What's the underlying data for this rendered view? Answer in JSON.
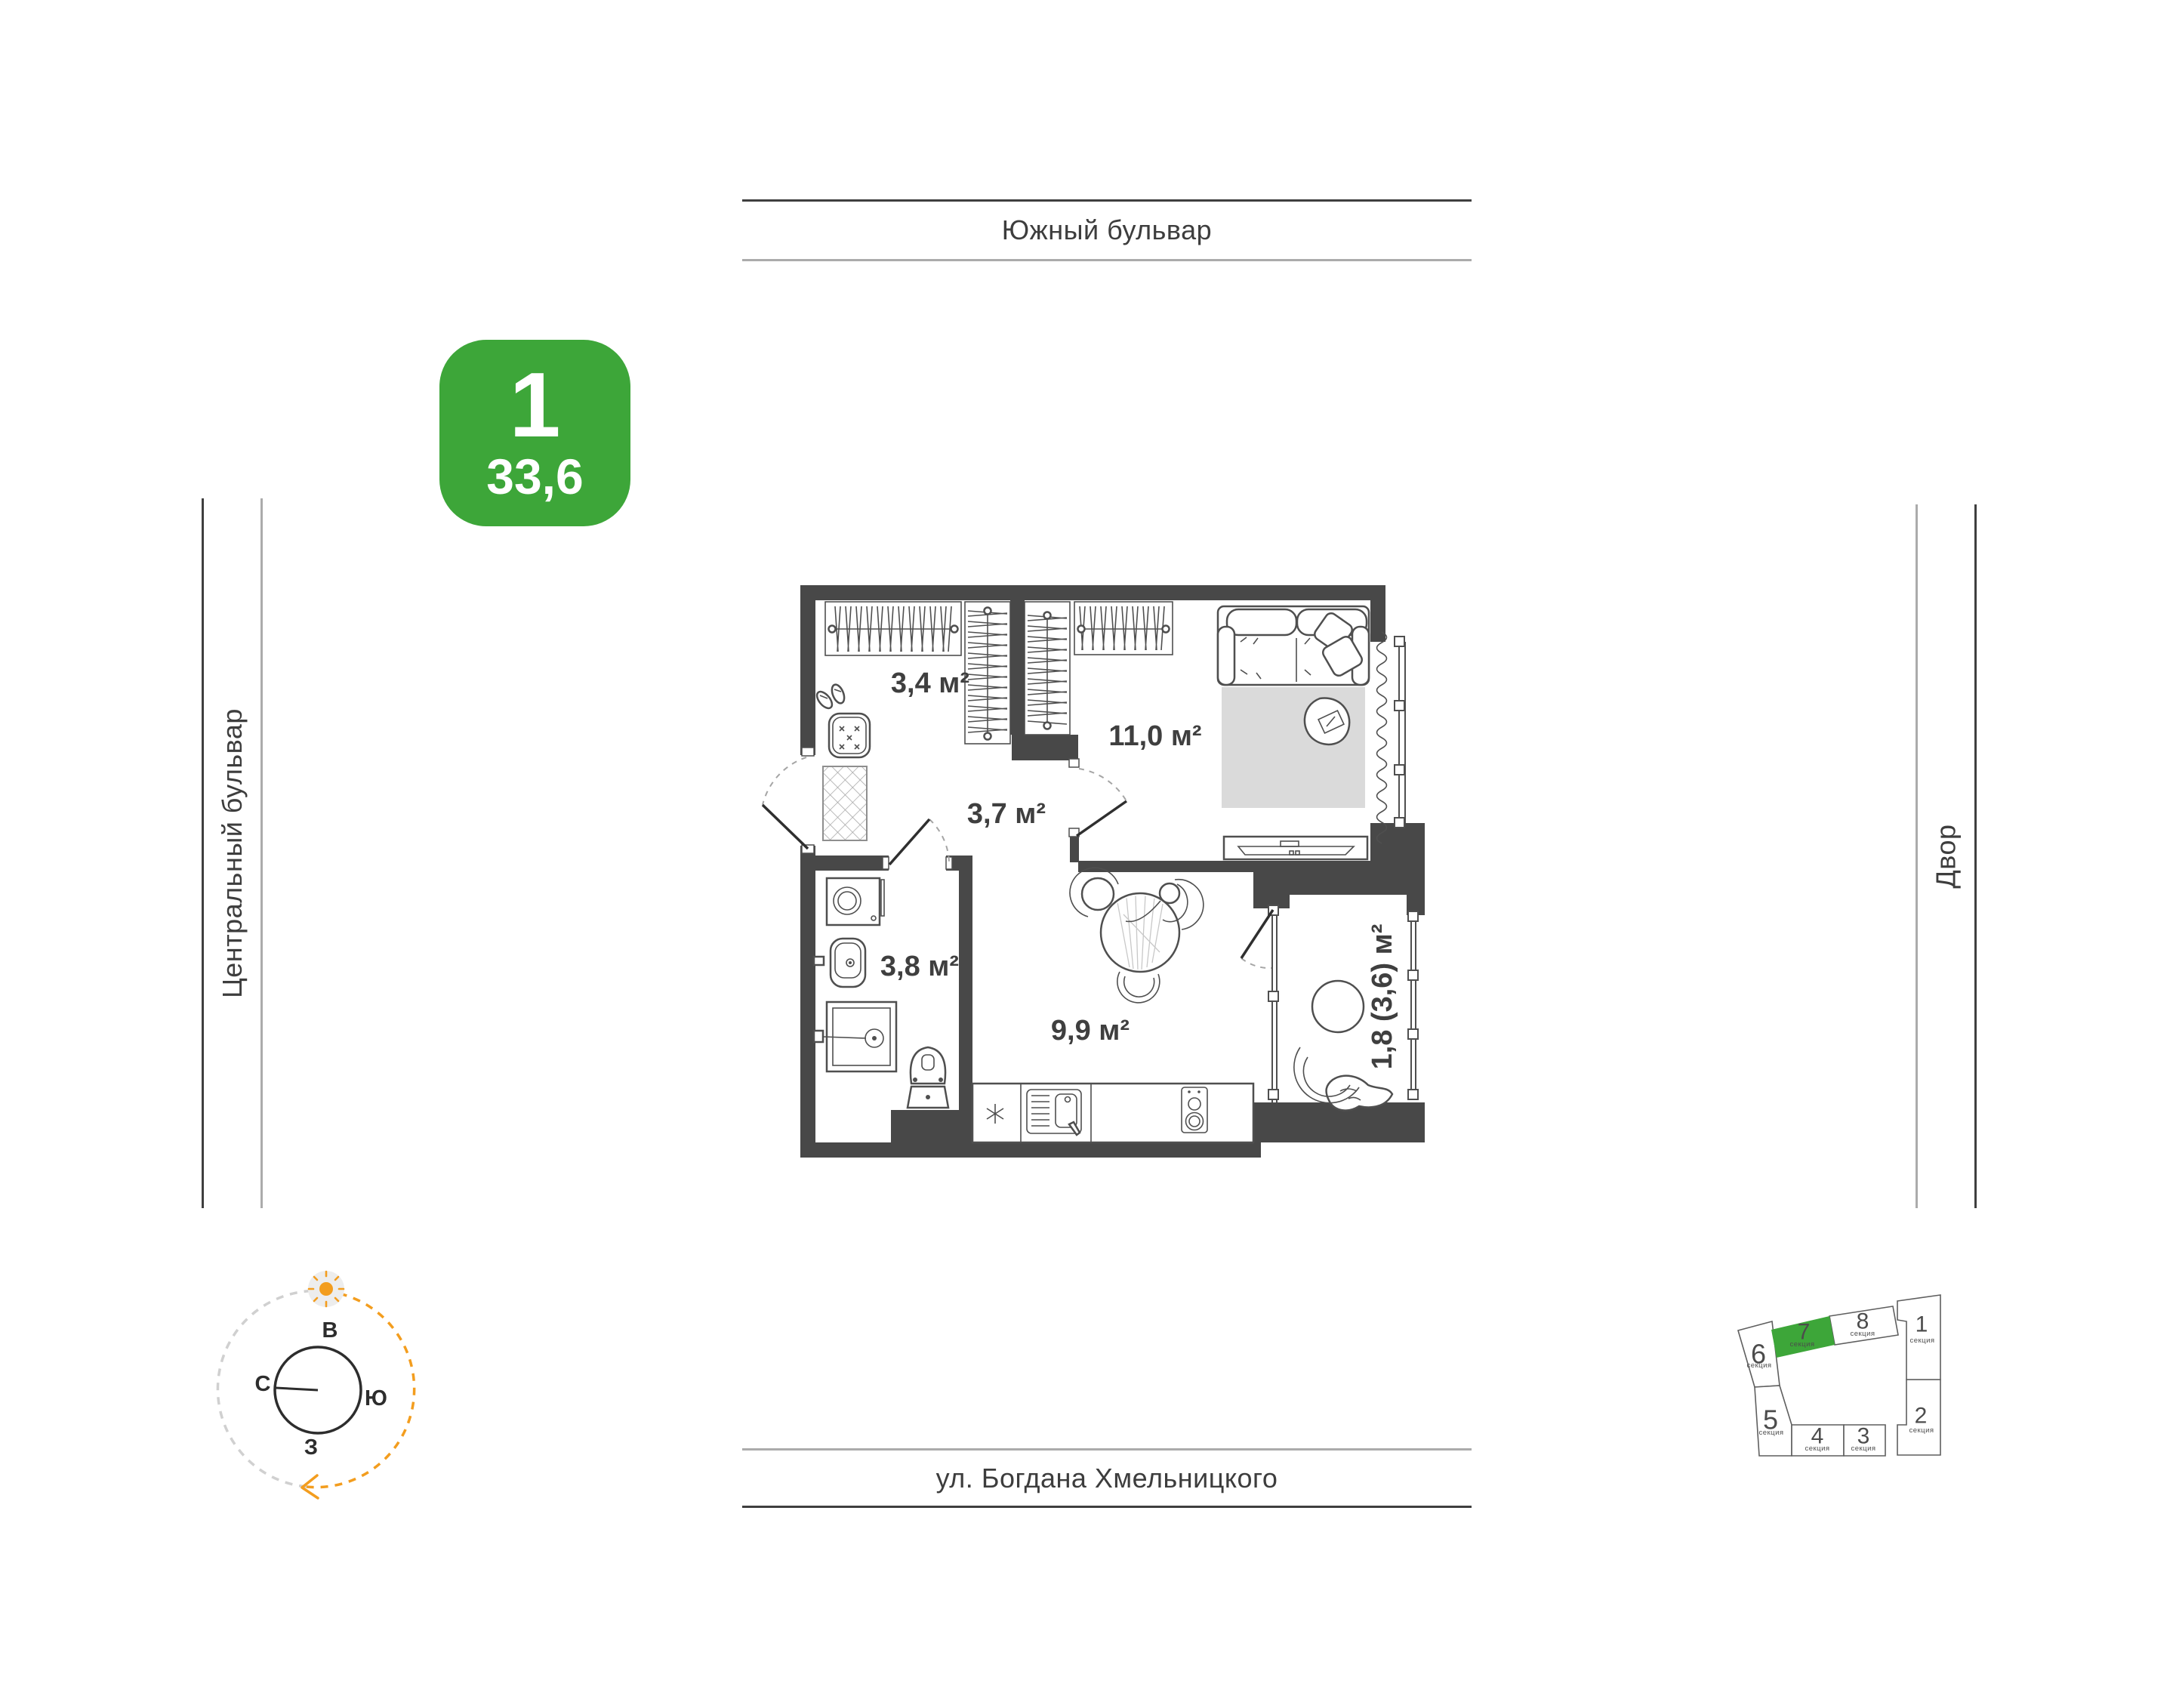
{
  "badge": {
    "rooms_count": "1",
    "area": "33,6"
  },
  "streets": {
    "top": "Южный бульвар",
    "left": "Центральный бульвар",
    "right": "Двор",
    "bottom": "ул. Богдана Хмельницкого"
  },
  "floorplan": {
    "areas": {
      "hallway": "3,4 м²",
      "living": "11,0 м²",
      "corridor": "3,7 м²",
      "bathroom": "3,8 м²",
      "kitchen": "9,9 м²",
      "balcony": "1,8 (3,6) м²"
    }
  },
  "compass": {
    "east": "В",
    "south": "Ю",
    "west": "З",
    "north": "С"
  },
  "minimap": {
    "sections": [
      {
        "number": "1",
        "label": "секция",
        "highlighted": false
      },
      {
        "number": "2",
        "label": "секция",
        "highlighted": false
      },
      {
        "number": "3",
        "label": "секция",
        "highlighted": false
      },
      {
        "number": "4",
        "label": "секция",
        "highlighted": false
      },
      {
        "number": "5",
        "label": "секция",
        "highlighted": false
      },
      {
        "number": "6",
        "label": "секция",
        "highlighted": false
      },
      {
        "number": "7",
        "label": "секция",
        "highlighted": true
      },
      {
        "number": "8",
        "label": "секция",
        "highlighted": false
      }
    ]
  },
  "colors": {
    "accent_green": "#3da639",
    "sun_orange": "#f39d1e"
  }
}
